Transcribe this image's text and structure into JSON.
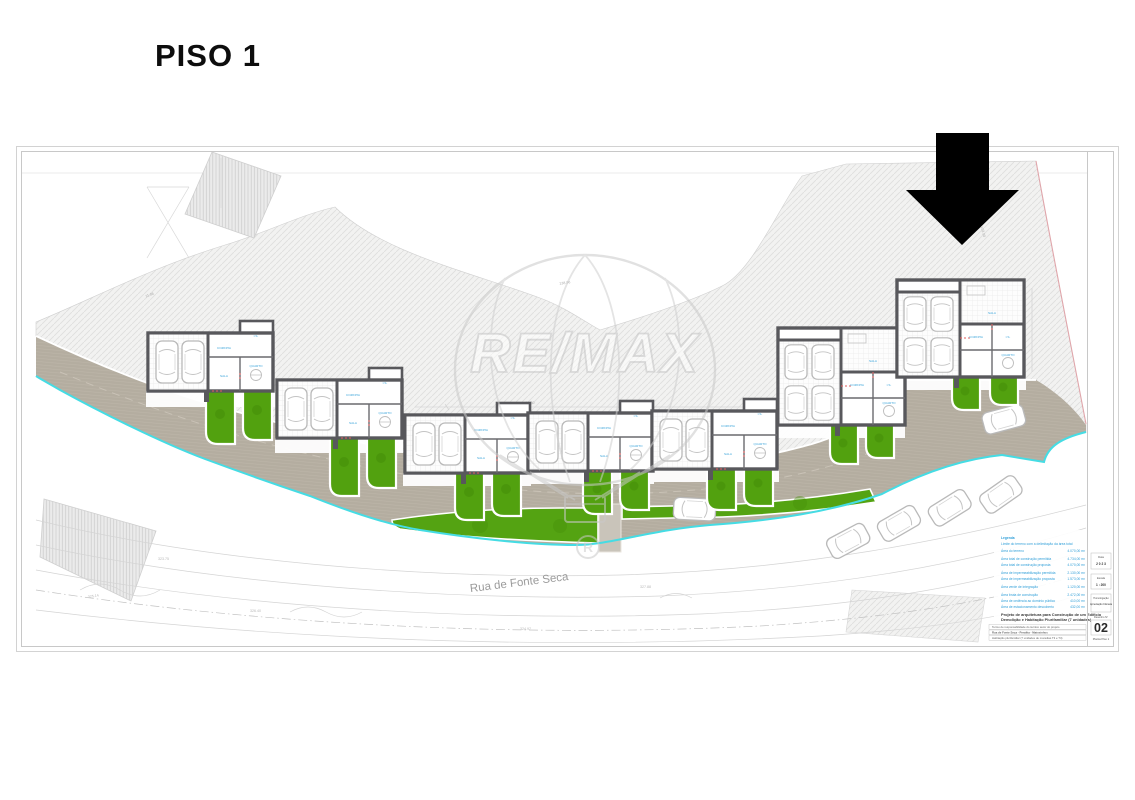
{
  "page": {
    "floor_label": "PISO 1"
  },
  "plan": {
    "street_label": "Rua de Fonte Seca",
    "watermark_brand": "RE/MAX",
    "watermark_registered": "R",
    "room_labels": {
      "living": "SALA",
      "kitchen": "COZINHA",
      "bath": "I.S.",
      "room": "QUARTO"
    },
    "dim_labels": {
      "d1": "17.30",
      "d2": "17.30",
      "d3": "138.96",
      "d4": "11.86",
      "d5": "103.00"
    },
    "contour_labels": {
      "c1": "325.14",
      "c2": "326.40",
      "c3": "324.97",
      "c4": "327.88",
      "c5": "328.15",
      "c6": "323.75"
    }
  },
  "titleblock": {
    "legend_heading": "Legenda",
    "legend_intro": "Limite do terreno com a delimitação da área total",
    "legend_lines": [
      {
        "label": "Área do terreno",
        "value": "4.070,00 m²"
      },
      {
        "label": "Área total de construção permitida",
        "value": "4.734,00 m²"
      },
      {
        "label": "Área total de construção proposta",
        "value": "4.070,00 m²"
      },
      {
        "label": "Área de impermeabilização permitida",
        "value": "2.130,00 m²"
      },
      {
        "label": "Área de impermeabilização proposta",
        "value": "1.573,00 m²"
      },
      {
        "label": "Área verde de integração",
        "value": "1.120,00 m²"
      },
      {
        "label": "Área bruta de construção",
        "value": "2.472,00 m²"
      },
      {
        "label": "Área de cedência ao domínio público",
        "value": "410,00 m²"
      },
      {
        "label": "Área de estacionamento descoberto",
        "value": "432,00 m²"
      }
    ],
    "project_title_line1": "Projeto de arquitetura para Construção de um Edifício",
    "project_title_line2": "Demolição e Habitação Plurifamiliar (7 unidades)",
    "info_rows": [
      "Termo de responsabilidade do técnico autor do projeto",
      "Rua de Fonte Seca - Perafita - Matosinhos",
      "Habitação plurifamiliar (7 unidades de moradias T3 e T4)"
    ],
    "meta": {
      "date_label": "Data",
      "date_value": "2 0 2 3",
      "scale_label": "Escala",
      "scale_value": "1 : 200",
      "stage_label": "Homologação",
      "stage_value": "Apreciação Câmara",
      "sheet_label": "Desenho Nº",
      "sheet_number": "02",
      "sheet_caption": "Planta Piso 1"
    }
  }
}
